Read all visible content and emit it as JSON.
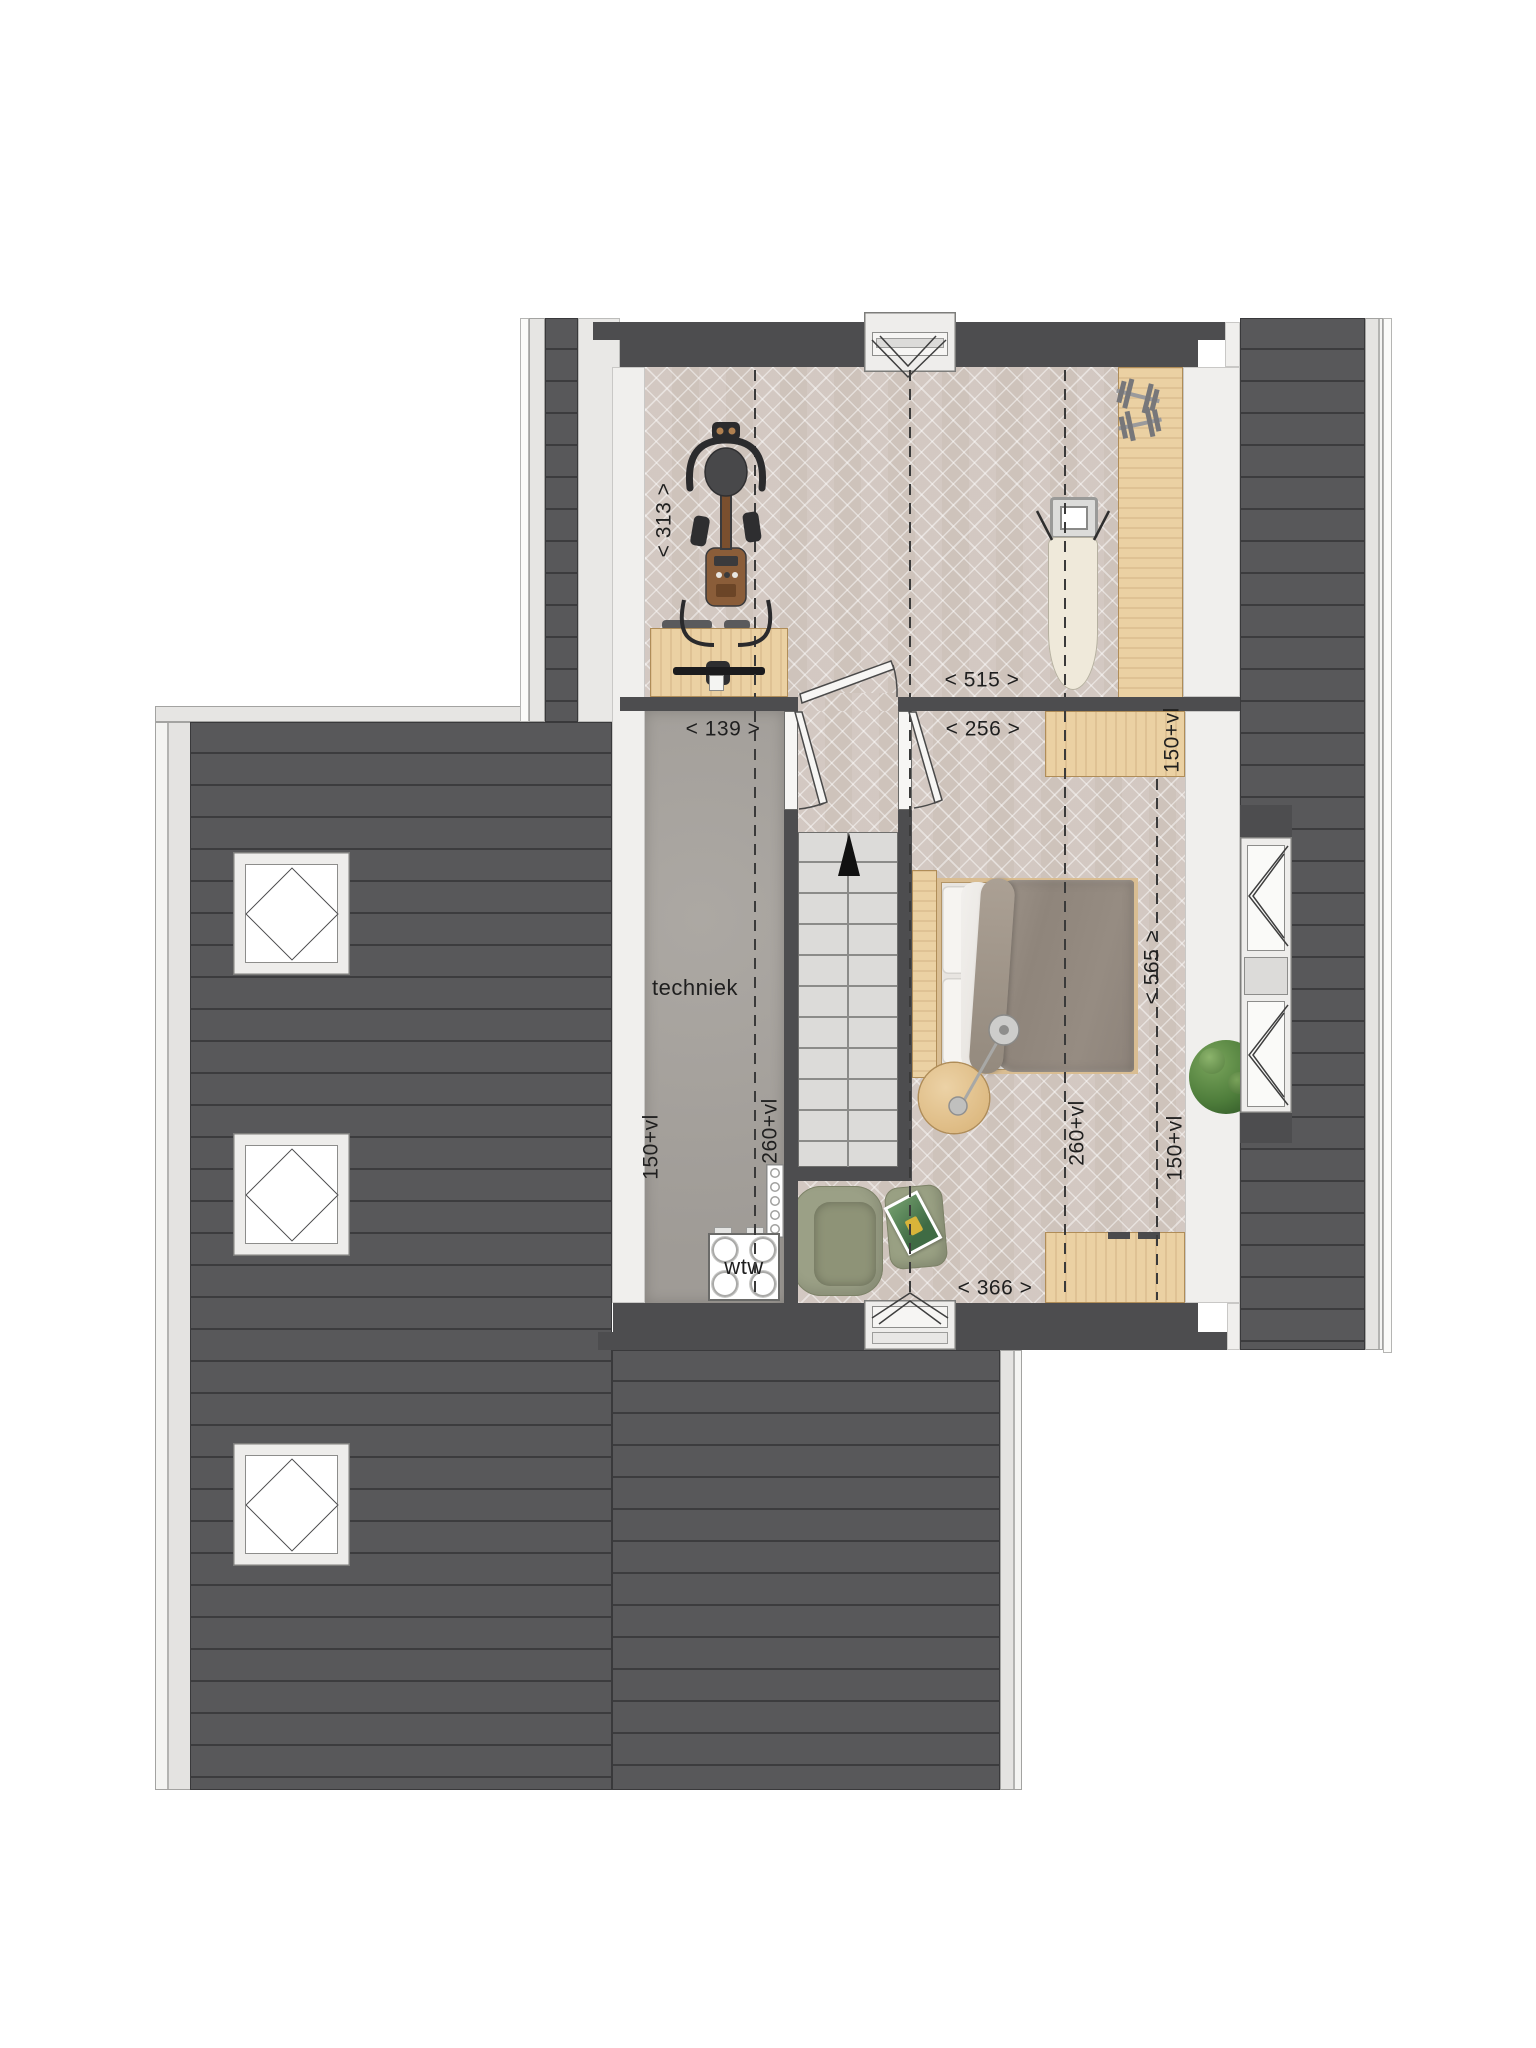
{
  "plan_labels": {
    "room_techniek": "techniek",
    "wtw_unit": "wtw"
  },
  "dimensions": {
    "gym_depth": "< 313 >",
    "gym_width": "< 515 >",
    "techniek_width": "< 139 >",
    "landing_width": "< 256 >",
    "bedroom_depth": "< 565 >",
    "bedroom_width": "< 366 >",
    "knee_wall": [
      "150+vl",
      "150+vl",
      "150+vl"
    ],
    "headroom": [
      "260+vl",
      "260+vl"
    ]
  },
  "colors": {
    "roof": "#58585a",
    "roof_line": "#3c3c3e",
    "wall": "#4d4d4f",
    "exterior_trim": "#e6e5e3",
    "interior_wall": "#f0efed",
    "wood_floor": "#d9d0ca",
    "concrete_floor": "#a6a29d",
    "wood_furniture": "#ebd1a3",
    "stairs": "#dcdbd9",
    "bed_duvet": "#948a80",
    "armchair": "#99a084",
    "plant": "#4e7d3b",
    "label_text": "#1f1f1f"
  }
}
